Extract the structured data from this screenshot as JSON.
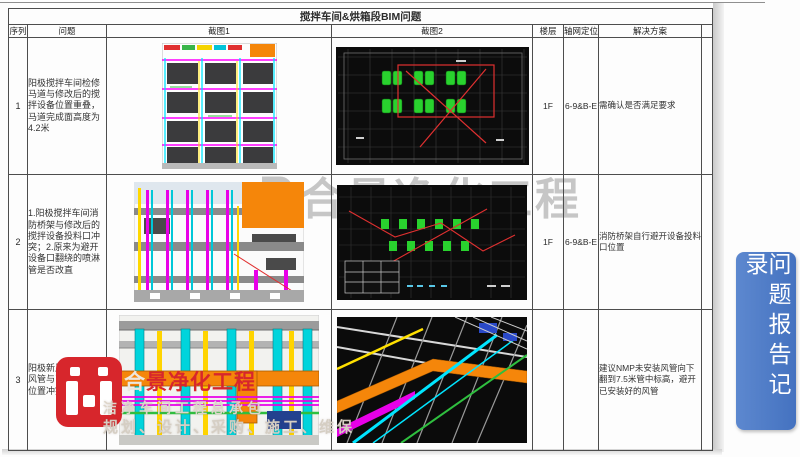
{
  "report": {
    "title": "搅拌车间&烘箱段BIM问题",
    "columns": {
      "seq": "序列",
      "problem": "问题",
      "screenshot1": "截图1",
      "screenshot2": "截图2",
      "floor": "楼层",
      "axis": "轴网定位",
      "solution": "解决方案"
    },
    "rows": [
      {
        "seq": "1",
        "problem": "阳极搅拌车间检修马道与修改后的搅拌设备位置重叠，马道完成面高度为4.2米",
        "floor": "1F",
        "axis": "6-9&B-E",
        "solution": "需确认是否满足要求"
      },
      {
        "seq": "2",
        "problem": "1.阳极搅拌车间消防桥架与修改后的搅拌设备投料口冲突；2.原来为避开设备口翻绕的喷淋管是否改直",
        "floor": "1F",
        "axis": "6-9&B-E",
        "solution": "消防桥架自行避开设备投料口位置"
      },
      {
        "seq": "3",
        "problem": "阳极新风机组尾排风管与已安装风管位置冲突",
        "floor": "",
        "axis": "",
        "solution": "建议NMP未安装风管向下翻到7.5米管中标高，避开已安装好的风管"
      }
    ]
  },
  "center_watermark": {
    "text": "合景净化工程",
    "color": "#c6c6c6"
  },
  "company_logo": {
    "brand_prefix": "合",
    "brand": "景净化工程",
    "subtitle": "洁净车间工程总承包",
    "services": "规划、设计、采购、施工、维保",
    "red": "#d7262c"
  },
  "side_banner": {
    "text": "问题报告记录",
    "bg_color": "#4b79c4",
    "text_color": "#ffffff"
  }
}
